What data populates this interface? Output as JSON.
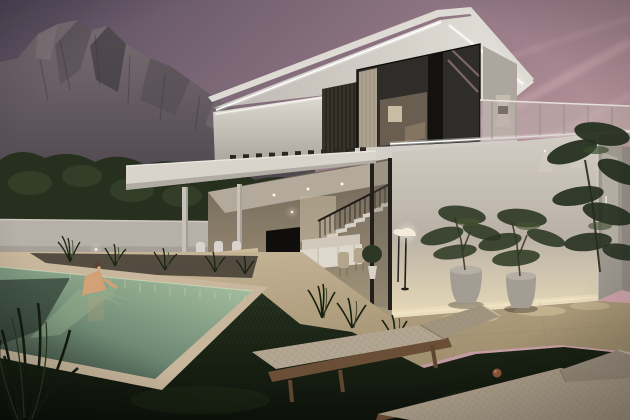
{
  "scene": {
    "description": "Dusk exterior rendering: modern two-storey white villa with LED cove lighting, glass corner bedroom, open living terrace, swimming pool with swimmer, sun loungers on dark lawn, potted trees, rocky mountain under a purple-pink evening sky",
    "objects": [
      "dusk-sky",
      "contrail-clouds",
      "rocky-mountain",
      "treeline",
      "perimeter-wall",
      "villa-upper-roof",
      "led-strips",
      "louvre-panel",
      "bedroom-corner-window",
      "glass-balustrade",
      "lower-volume",
      "entrance-door",
      "living-terrace",
      "staircase",
      "tv",
      "sofa",
      "outdoor-dining-set",
      "coffee-table",
      "pergola",
      "pool",
      "swimmer",
      "pool-deck",
      "ornamental-grasses",
      "lawn-grass",
      "sun-loungers",
      "potted-trees",
      "outdoor-floor-lamp",
      "foreground-plant"
    ]
  },
  "colors": {
    "sky_top": "#564c5e",
    "sky_mid": "#8b7280",
    "sky_pink": "#d0a5ab",
    "cloud_streak": "#e3bec2",
    "mountain_top": "#7a6e74",
    "mountain_base": "#4a434a",
    "mountain_shadow": "#433d43",
    "mountain_light": "#8a7d82",
    "treeline": "#27301f",
    "tree_highlight": "#38452b",
    "wall": "#b6b0a8",
    "wall_top_edge": "#ccc7bf",
    "house_white": "#dedbd4",
    "soffit_left": "#bdb8b1",
    "soffit_right": "#e6e3dc",
    "west_wall_top": "#e0dcd4",
    "west_wall_bottom": "#a9a39b",
    "led": "#ffffff",
    "louvre": "#38342c",
    "glass": "#2f2d29",
    "curtain": "#b7ab97",
    "interior_glow": "#6e6152",
    "artwork": "#d3c6ac",
    "balustrade_tint_a": "#c7b6b4",
    "balustrade_tint_b": "#beb3ab",
    "face_top": "#d2cdc5",
    "face_mid": "#b9b1a5",
    "face_base_glow": "#e8dab8",
    "side_face": "#9d978e",
    "door": "#b2aca2",
    "ceiling": "#b3aa9b",
    "interior_top": "#6f6457",
    "interior_floor": "#a5987e",
    "sofa": "#ddd7cc",
    "tv": "#0f0e0c",
    "table_wood": "#cdbc9c",
    "chair_white": "#d8d4cd",
    "deck_light": "#cbb99c",
    "deck_dark": "#a1906f",
    "bed_soil": "#3f3a30",
    "coping": "#c8b79c",
    "pool_far": "#a7bfa0",
    "pool_mid": "#6f8b75",
    "pool_near": "#333f36",
    "ripple": "#cfe0bd",
    "skin": "#d2a175",
    "hair": "#5a4334",
    "grass_top": "#283420",
    "grass_bottom": "#0d120a",
    "foliage_dark": "#2b3722",
    "foliage_deep": "#1d2618",
    "foliage_light": "#46552f",
    "pot": "#a39d93",
    "trunk": "#4a4336",
    "cushion": "#b3a692",
    "cushion_back": "#a2957f",
    "frame_wood": "#6b4e36",
    "wheel": "#8a5536",
    "lamp_glow": "#f4ecd8"
  }
}
